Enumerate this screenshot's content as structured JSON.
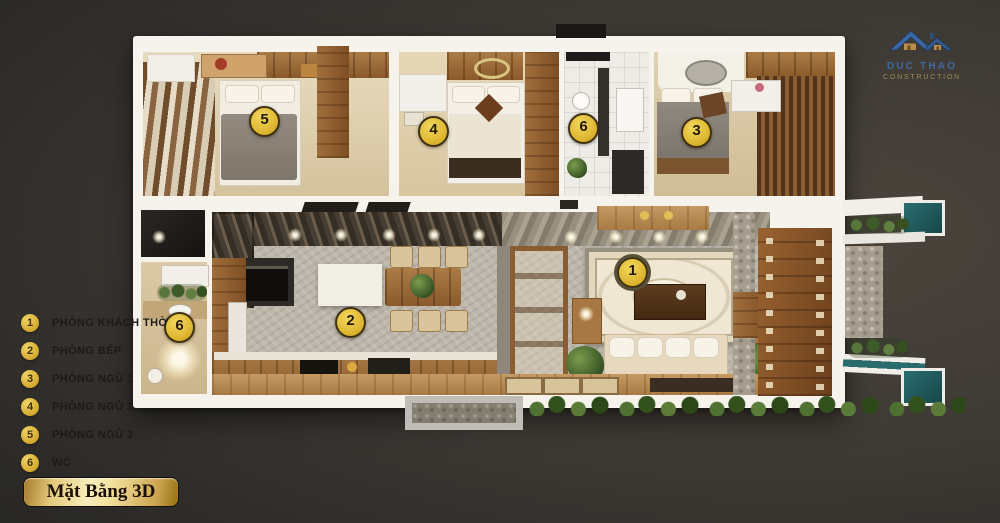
{
  "title_badge": {
    "text": "Mặt Bằng 3D"
  },
  "logo": {
    "name": "DUC THAO",
    "subtitle": "CONSTRUCTION",
    "name_color": "#41699f",
    "subtitle_color": "#a08a58"
  },
  "legend": {
    "items": [
      {
        "num": "1",
        "label": "PHÒNG KHÁCH THỜ"
      },
      {
        "num": "2",
        "label": "PHÒNG BẾP"
      },
      {
        "num": "3",
        "label": "PHÒNG NGỦ 1"
      },
      {
        "num": "4",
        "label": "PHÒNG NGỦ 2"
      },
      {
        "num": "5",
        "label": "PHÒNG NGỦ 3"
      },
      {
        "num": "6",
        "label": "WC"
      }
    ]
  },
  "floor_plan": {
    "markers": [
      {
        "num": "5",
        "room": "PHÒNG NGỦ 3"
      },
      {
        "num": "4",
        "room": "PHÒNG NGỦ 2"
      },
      {
        "num": "6",
        "room": "WC"
      },
      {
        "num": "3",
        "room": "PHÒNG NGỦ 1"
      },
      {
        "num": "1",
        "room": "PHÒNG KHÁCH THỜ"
      },
      {
        "num": "2",
        "room": "PHÒNG BẾP"
      },
      {
        "num": "6",
        "room": "WC"
      }
    ],
    "colors": {
      "marker_fill": "#ddb52f",
      "marker_border": "#3f3110",
      "accent_gold": "#d3a92f"
    }
  }
}
